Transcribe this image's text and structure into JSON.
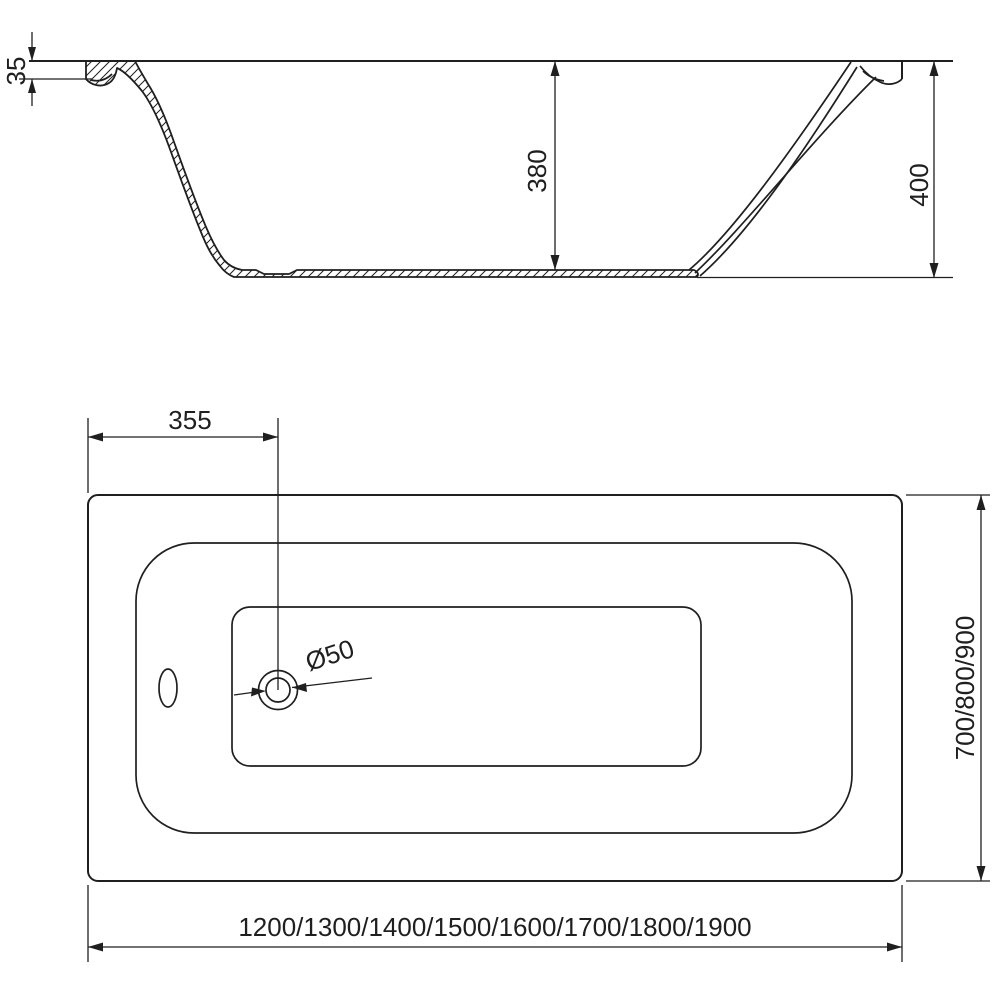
{
  "drawing": {
    "type": "bathtub-technical-drawing",
    "colors": {
      "line": "#1f1f1f",
      "background": "#ffffff"
    },
    "side_view": {
      "dim_rim_height": "35",
      "dim_inner_depth": "380",
      "dim_overall_height": "400"
    },
    "plan_view": {
      "dim_drain_offset": "355",
      "dim_drain_diameter": "Ø50",
      "dim_width_options": "700/800/900",
      "dim_length_options": "1200/1300/1400/1500/1600/1700/1800/1900"
    }
  }
}
